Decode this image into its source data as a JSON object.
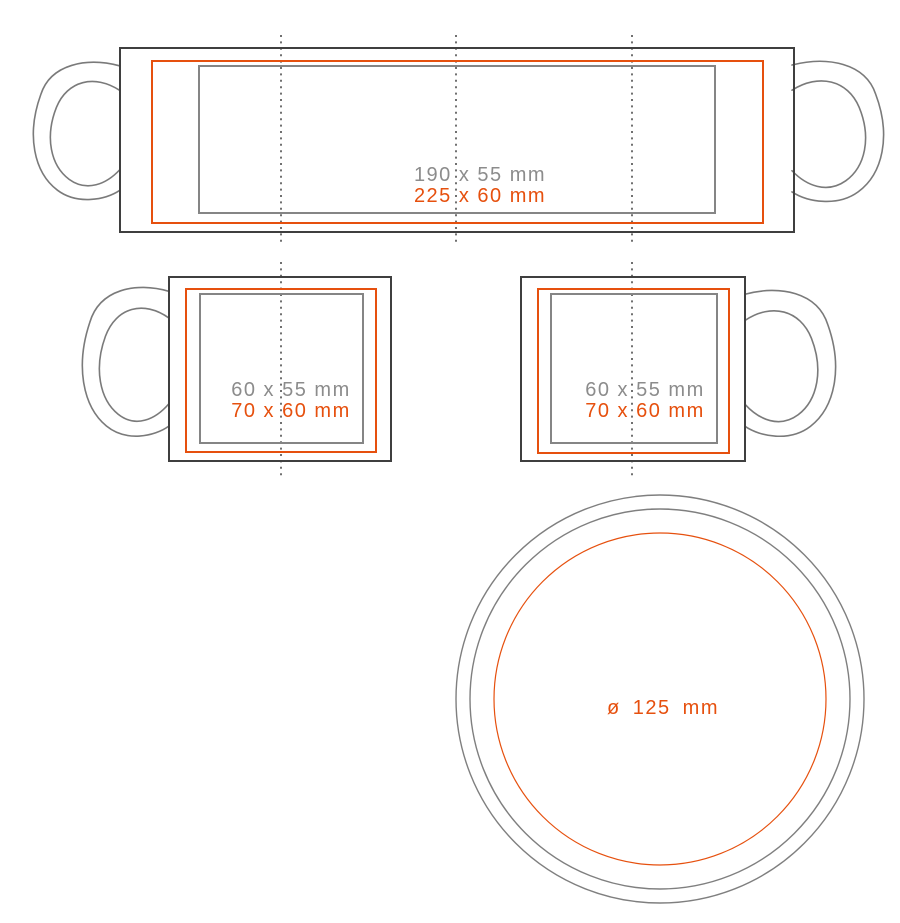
{
  "colors": {
    "background": "#ffffff",
    "mug_outline_dark": "#3f3f3f",
    "print_area_gray": "#858585",
    "max_print_orange": "#e6500e",
    "label_gray": "#8c8c8c",
    "guide_dotted": "#4d4d4d"
  },
  "wrap_view": {
    "print_area_label": "190 x 55 mm",
    "max_print_label": "225 x 60 mm"
  },
  "left_side_view": {
    "print_area_label": "60 x 55 mm",
    "max_print_label": "70 x 60 mm"
  },
  "right_side_view": {
    "print_area_label": "60 x 55 mm",
    "max_print_label": "70 x 60 mm"
  },
  "bottom_view": {
    "diameter_label": "ø  125  mm"
  }
}
